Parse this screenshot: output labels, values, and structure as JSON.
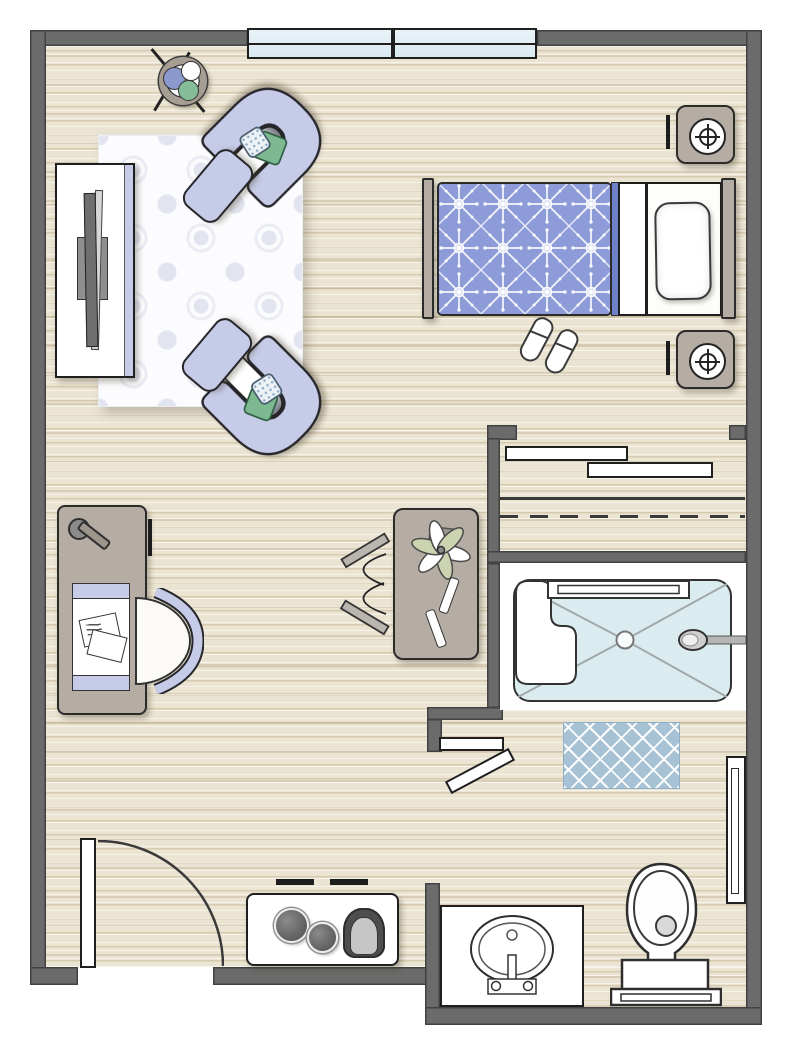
{
  "document": {
    "type": "floor-plan",
    "subject": "studio apartment / senior-living suite top-view floor plan",
    "visible_text": []
  },
  "palette": {
    "wall": "#6b6b6b",
    "wall_edge": "#424242",
    "floor_base": "#ebe4d2",
    "floor_grain": "#ac986c",
    "window_glass": "#e9f2f7",
    "outline": "#262626",
    "upholstery_lavender": "#c6cce8",
    "pillow_green": "#7cb890",
    "pillow_dot_blue": "#7fa3c4",
    "rug_white": "#fcfcfe",
    "rug_motif": "#e2e5f0",
    "bedding_blue": "#8d9bd8",
    "bedding_fold_blue": "#6d80c8",
    "wood_taupe": "#b5aca3",
    "shower_blue": "#dbecf1",
    "bath_mat_blue": "#a7c2d4",
    "fixture_white": "#ffffff",
    "metal_gray": "#8f8f8f"
  },
  "rooms": [
    {
      "name": "living-sleeping-area",
      "items": [
        "tv-console",
        "television",
        "area-rug",
        "armchair-1",
        "armchair-2",
        "ottoman-1",
        "ottoman-2",
        "green-throw-pillows",
        "patterned-throw-pillows",
        "round-side-table",
        "bed",
        "bed-pillow",
        "headboard",
        "footboard",
        "nightstand-1",
        "nightstand-2",
        "table-lamp-1",
        "table-lamp-2",
        "slippers",
        "desk",
        "desk-lamp",
        "desk-tray",
        "papers",
        "desk-chair",
        "center-table",
        "potted-plant",
        "folding-rack",
        "window-1",
        "window-2"
      ]
    },
    {
      "name": "closet",
      "items": [
        "shelf-1",
        "shelf-2",
        "closet-rod-solid",
        "closet-rod-dashed"
      ]
    },
    {
      "name": "bathroom",
      "items": [
        "shower-pan",
        "shower-bench",
        "shower-glass-door",
        "shower-head",
        "shower-drain",
        "bath-mat",
        "toilet",
        "sink-vanity",
        "towel-bar",
        "bifold-door-panel-1",
        "bifold-door-panel-2"
      ]
    },
    {
      "name": "kitchenette",
      "items": [
        "counter",
        "burner-1",
        "burner-2",
        "kitchen-faucet",
        "cabinet-mark-1",
        "cabinet-mark-2"
      ]
    },
    {
      "name": "entry",
      "items": [
        "entry-door-leaf",
        "entry-door-swing-arc"
      ]
    }
  ]
}
